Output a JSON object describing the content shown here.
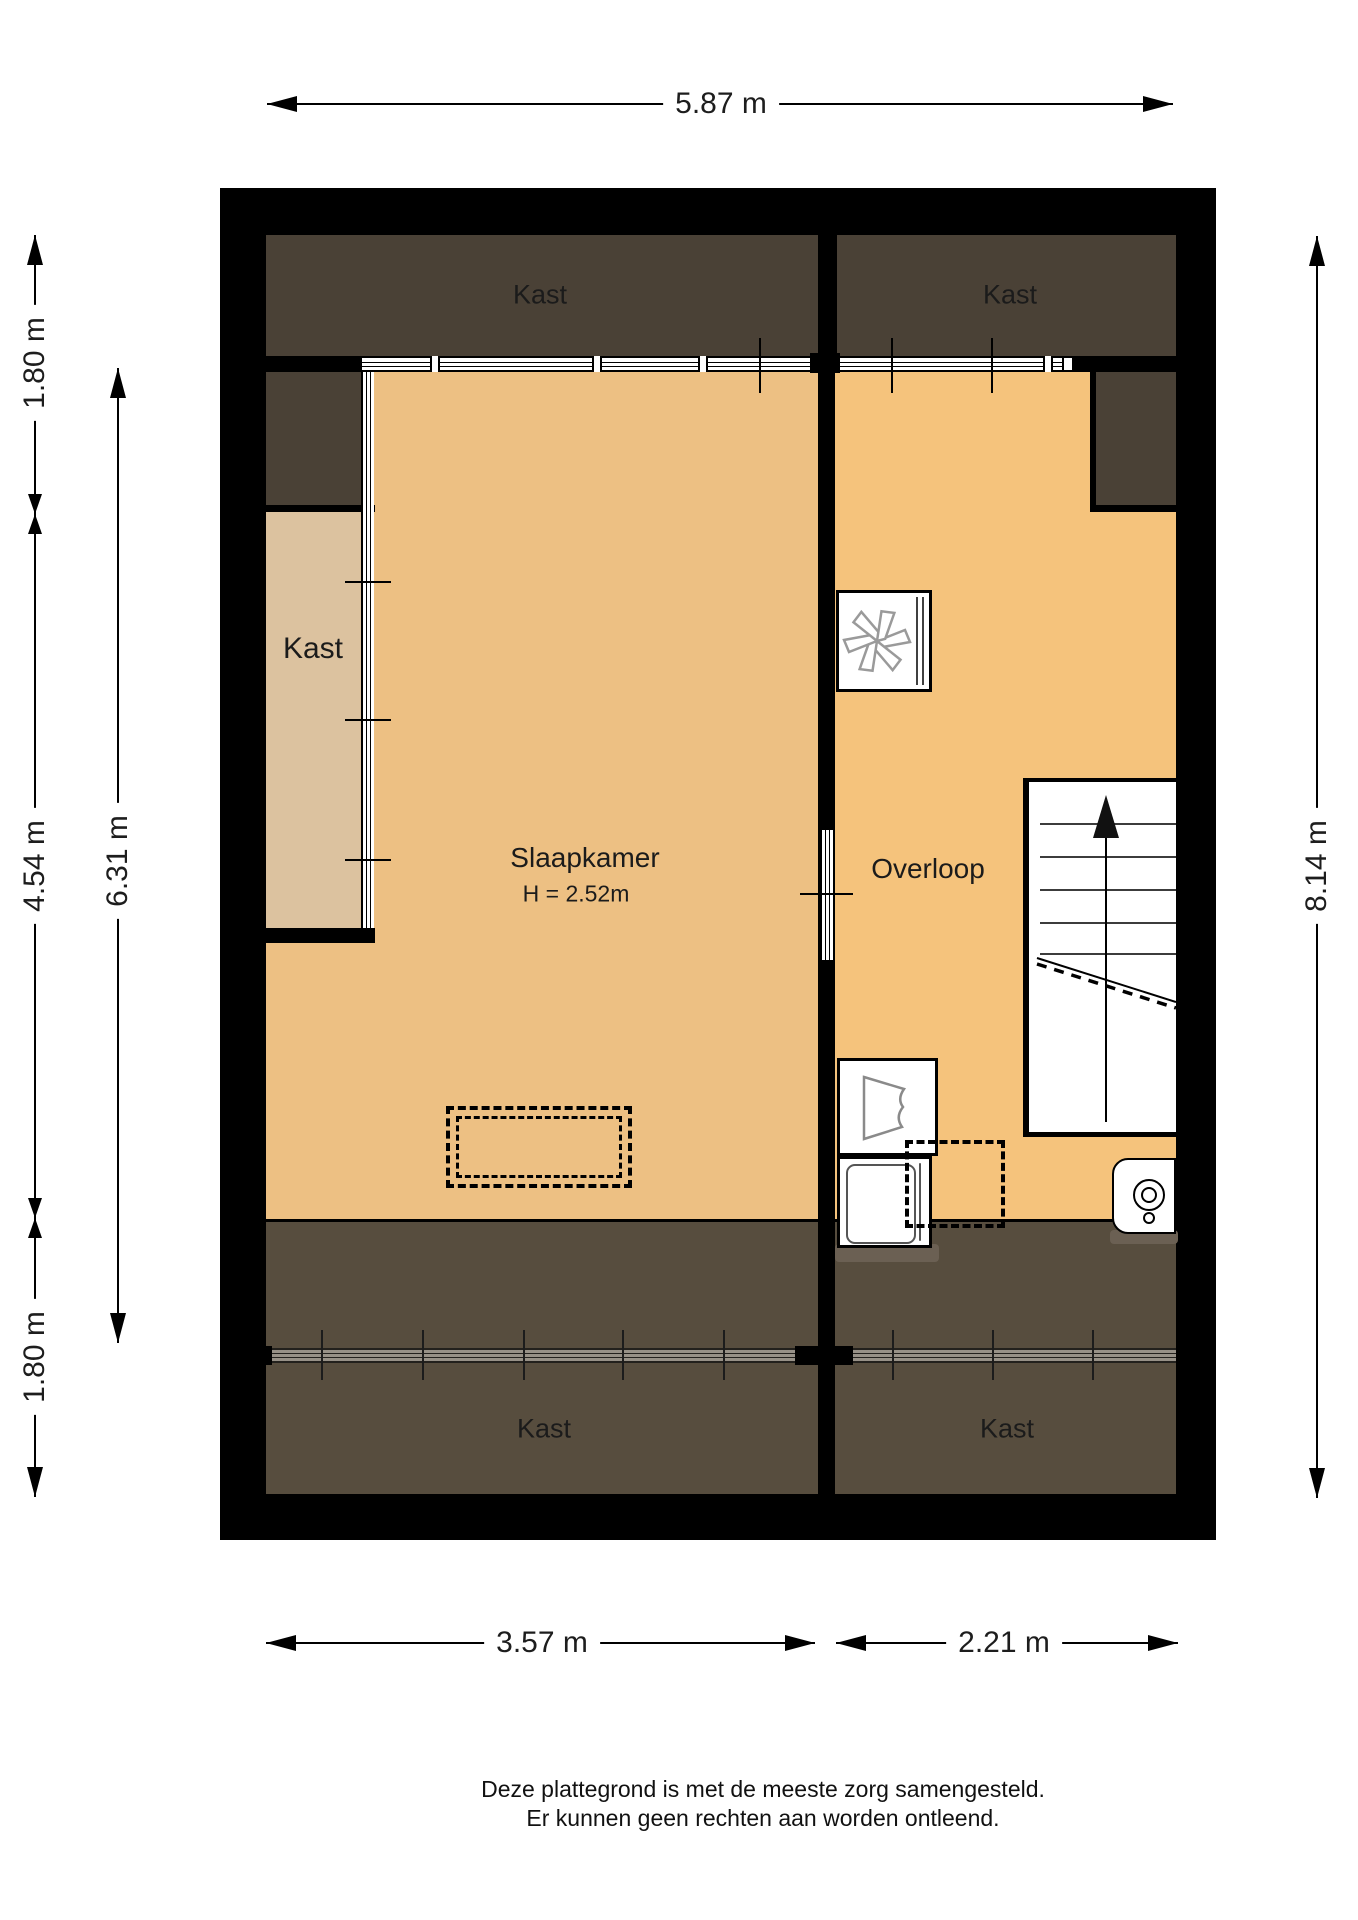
{
  "rooms": {
    "kast_top_left": {
      "label": "Kast"
    },
    "kast_top_right": {
      "label": "Kast"
    },
    "kast_left": {
      "label": "Kast"
    },
    "kast_bottom_left": {
      "label": "Kast"
    },
    "kast_bottom_right": {
      "label": "Kast"
    },
    "slaapkamer": {
      "label": "Slaapkamer",
      "height_note": "H = 2.52m"
    },
    "overloop": {
      "label": "Overloop"
    }
  },
  "dimensions": {
    "top_width": "5.87 m",
    "left_outer": {
      "top": "1.80 m",
      "middle": "4.54 m",
      "bottom": "1.80 m"
    },
    "left_inner": "6.31 m",
    "right_height": "8.14 m",
    "bottom_left_width": "3.57 m",
    "bottom_right_width": "2.21 m"
  },
  "footer": {
    "line1": "Deze plattegrond is met de meeste zorg samengesteld.",
    "line2": "Er kunnen geen rechten aan worden ontleend."
  },
  "icons": {
    "ventilation_fan_icon": "pinwheel-fan",
    "stairs_up_arrow_icon": "arrow-up",
    "sink_icon": "basin",
    "boiler_icon": "concentric-circles"
  },
  "colors": {
    "wall": "#000000",
    "floor_slaapkamer": "#edc083",
    "floor_overloop": "#f5c37c",
    "closet_floor": "#dcc29f",
    "low_roof_dark_top": "#4a4136",
    "low_roof_dark_bottom": "#574d3e",
    "paper": "#ffffff"
  }
}
